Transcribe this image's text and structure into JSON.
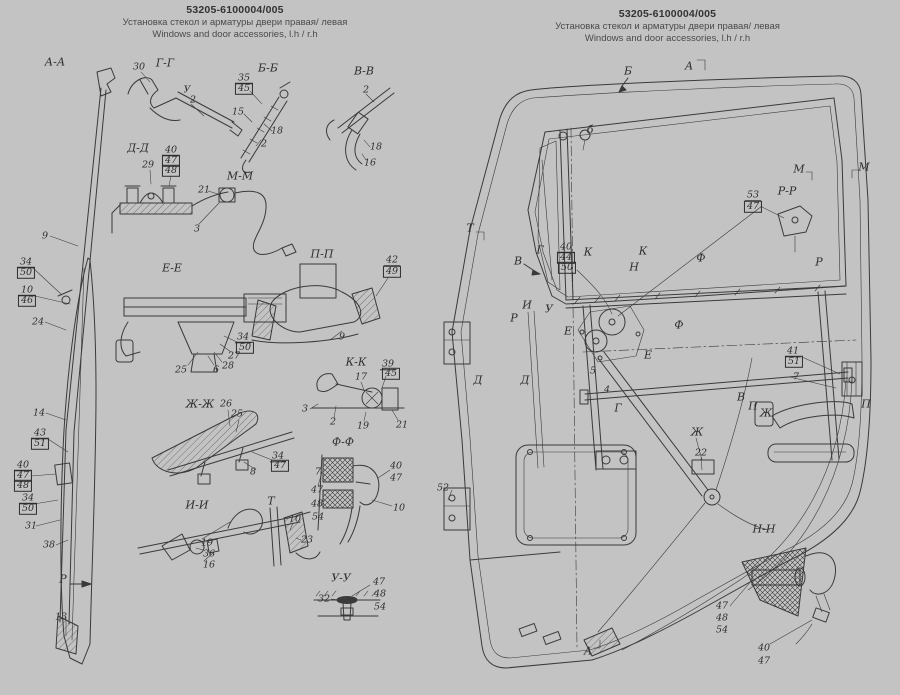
{
  "page": {
    "bg_color": "#c3c3c3",
    "ink_color": "#3a3a3a"
  },
  "titles": {
    "left": {
      "part_number": "53205-6100004/005",
      "title_ru": "Установка стекол и арматуры двери правая/ левая",
      "title_en": "Windows and door accessories, l.h / r.h"
    },
    "right": {
      "part_number": "53205-6100004/005",
      "title_ru": "Установка стекол и арматуры двери правая/ левая",
      "title_en": "Windows and door accessories, l.h / r.h"
    }
  },
  "labels": [
    {
      "t": "А-А",
      "x": 55,
      "y": 62,
      "s": "sec"
    },
    {
      "t": "Г-Г",
      "x": 165,
      "y": 63,
      "s": "sec"
    },
    {
      "t": "Б-Б",
      "x": 268,
      "y": 68,
      "s": "sec"
    },
    {
      "t": "В-В",
      "x": 364,
      "y": 71,
      "s": "sec"
    },
    {
      "t": "Д-Д",
      "x": 138,
      "y": 148,
      "s": "sec"
    },
    {
      "t": "М-М",
      "x": 240,
      "y": 176,
      "s": "sec"
    },
    {
      "t": "Е-Е",
      "x": 172,
      "y": 268,
      "s": "sec"
    },
    {
      "t": "П-П",
      "x": 322,
      "y": 254,
      "s": "sec"
    },
    {
      "t": "Ж-Ж",
      "x": 200,
      "y": 404,
      "s": "sec"
    },
    {
      "t": "К-К",
      "x": 356,
      "y": 362,
      "s": "sec"
    },
    {
      "t": "Ф-Ф",
      "x": 343,
      "y": 442,
      "s": "sec"
    },
    {
      "t": "И-И",
      "x": 197,
      "y": 505,
      "s": "sec"
    },
    {
      "t": "Т",
      "x": 271,
      "y": 501,
      "s": "sec"
    },
    {
      "t": "У-У",
      "x": 341,
      "y": 578,
      "s": "sec"
    },
    {
      "t": "Р",
      "x": 63,
      "y": 579,
      "s": "sec"
    },
    {
      "t": "30",
      "x": 139,
      "y": 67,
      "s": "p"
    },
    {
      "t": "У",
      "x": 187,
      "y": 90,
      "s": "p"
    },
    {
      "t": "2",
      "x": 193,
      "y": 100,
      "s": "p"
    },
    {
      "t": "35",
      "x": 244,
      "y": 79,
      "s": "ul"
    },
    {
      "t": "45",
      "x": 244,
      "y": 89,
      "s": "bx"
    },
    {
      "t": "15",
      "x": 238,
      "y": 112,
      "s": "p"
    },
    {
      "t": "18",
      "x": 277,
      "y": 131,
      "s": "p"
    },
    {
      "t": "2",
      "x": 264,
      "y": 144,
      "s": "p"
    },
    {
      "t": "2",
      "x": 366,
      "y": 90,
      "s": "p"
    },
    {
      "t": "18",
      "x": 376,
      "y": 147,
      "s": "p"
    },
    {
      "t": "16",
      "x": 370,
      "y": 163,
      "s": "p"
    },
    {
      "t": "29",
      "x": 148,
      "y": 165,
      "s": "p"
    },
    {
      "t": "40",
      "x": 171,
      "y": 151,
      "s": "ul"
    },
    {
      "t": "47",
      "x": 171,
      "y": 161,
      "s": "bx"
    },
    {
      "t": "48",
      "x": 171,
      "y": 171,
      "s": "bx"
    },
    {
      "t": "21",
      "x": 204,
      "y": 190,
      "s": "p"
    },
    {
      "t": "3",
      "x": 197,
      "y": 229,
      "s": "p"
    },
    {
      "t": "9",
      "x": 45,
      "y": 236,
      "s": "p"
    },
    {
      "t": "34",
      "x": 26,
      "y": 263,
      "s": "ul"
    },
    {
      "t": "50",
      "x": 26,
      "y": 273,
      "s": "bx"
    },
    {
      "t": "10",
      "x": 27,
      "y": 291,
      "s": "ul"
    },
    {
      "t": "46",
      "x": 27,
      "y": 301,
      "s": "bx"
    },
    {
      "t": "24",
      "x": 38,
      "y": 322,
      "s": "p"
    },
    {
      "t": "14",
      "x": 39,
      "y": 413,
      "s": "p"
    },
    {
      "t": "43",
      "x": 40,
      "y": 434,
      "s": "ul"
    },
    {
      "t": "51",
      "x": 40,
      "y": 444,
      "s": "bx"
    },
    {
      "t": "40",
      "x": 23,
      "y": 466,
      "s": "ul"
    },
    {
      "t": "47",
      "x": 23,
      "y": 476,
      "s": "bx"
    },
    {
      "t": "48",
      "x": 23,
      "y": 486,
      "s": "bx"
    },
    {
      "t": "34",
      "x": 28,
      "y": 499,
      "s": "ul"
    },
    {
      "t": "50",
      "x": 28,
      "y": 509,
      "s": "bx"
    },
    {
      "t": "31",
      "x": 31,
      "y": 526,
      "s": "p"
    },
    {
      "t": "38",
      "x": 49,
      "y": 545,
      "s": "p"
    },
    {
      "t": "13",
      "x": 61,
      "y": 617,
      "s": "p"
    },
    {
      "t": "34",
      "x": 243,
      "y": 338,
      "s": "ul"
    },
    {
      "t": "50",
      "x": 245,
      "y": 348,
      "s": "bx"
    },
    {
      "t": "27",
      "x": 234,
      "y": 356,
      "s": "p"
    },
    {
      "t": "28",
      "x": 228,
      "y": 366,
      "s": "p"
    },
    {
      "t": "6",
      "x": 216,
      "y": 370,
      "s": "p"
    },
    {
      "t": "25",
      "x": 181,
      "y": 370,
      "s": "p"
    },
    {
      "t": "42",
      "x": 392,
      "y": 261,
      "s": "ul"
    },
    {
      "t": "49",
      "x": 392,
      "y": 272,
      "s": "bx"
    },
    {
      "t": "9",
      "x": 342,
      "y": 337,
      "s": "p"
    },
    {
      "t": "26",
      "x": 226,
      "y": 404,
      "s": "p"
    },
    {
      "t": "25",
      "x": 237,
      "y": 414,
      "s": "p"
    },
    {
      "t": "34",
      "x": 278,
      "y": 457,
      "s": "ul"
    },
    {
      "t": "47",
      "x": 280,
      "y": 466,
      "s": "bx"
    },
    {
      "t": "8",
      "x": 253,
      "y": 472,
      "s": "p"
    },
    {
      "t": "17",
      "x": 361,
      "y": 377,
      "s": "p"
    },
    {
      "t": "39",
      "x": 388,
      "y": 365,
      "s": "ul"
    },
    {
      "t": "45",
      "x": 391,
      "y": 374,
      "s": "bx"
    },
    {
      "t": "3",
      "x": 305,
      "y": 409,
      "s": "p"
    },
    {
      "t": "2",
      "x": 333,
      "y": 422,
      "s": "p"
    },
    {
      "t": "19",
      "x": 363,
      "y": 426,
      "s": "p"
    },
    {
      "t": "21",
      "x": 402,
      "y": 425,
      "s": "p"
    },
    {
      "t": "7",
      "x": 318,
      "y": 472,
      "s": "p"
    },
    {
      "t": "47",
      "x": 317,
      "y": 490,
      "s": "p"
    },
    {
      "t": "48",
      "x": 317,
      "y": 504,
      "s": "p"
    },
    {
      "t": "54",
      "x": 318,
      "y": 517,
      "s": "p"
    },
    {
      "t": "40",
      "x": 396,
      "y": 466,
      "s": "p"
    },
    {
      "t": "47",
      "x": 396,
      "y": 478,
      "s": "p"
    },
    {
      "t": "10",
      "x": 399,
      "y": 508,
      "s": "p"
    },
    {
      "t": "19",
      "x": 207,
      "y": 543,
      "s": "p"
    },
    {
      "t": "36",
      "x": 209,
      "y": 554,
      "s": "p"
    },
    {
      "t": "16",
      "x": 209,
      "y": 565,
      "s": "p"
    },
    {
      "t": "10",
      "x": 295,
      "y": 519,
      "s": "p"
    },
    {
      "t": "23",
      "x": 307,
      "y": 540,
      "s": "p"
    },
    {
      "t": "32",
      "x": 324,
      "y": 599,
      "s": "p"
    },
    {
      "t": "47",
      "x": 379,
      "y": 582,
      "s": "p"
    },
    {
      "t": "48",
      "x": 380,
      "y": 594,
      "s": "p"
    },
    {
      "t": "54",
      "x": 380,
      "y": 607,
      "s": "p"
    },
    {
      "t": "Б",
      "x": 628,
      "y": 71,
      "s": "sec"
    },
    {
      "t": "А",
      "x": 689,
      "y": 66,
      "s": "sec"
    },
    {
      "t": "б",
      "x": 590,
      "y": 130,
      "s": "sec"
    },
    {
      "t": "Т",
      "x": 470,
      "y": 228,
      "s": "sec"
    },
    {
      "t": "М",
      "x": 799,
      "y": 169,
      "s": "sec"
    },
    {
      "t": "М",
      "x": 864,
      "y": 167,
      "s": "sec"
    },
    {
      "t": "Р-Р",
      "x": 787,
      "y": 191,
      "s": "sec"
    },
    {
      "t": "Г",
      "x": 540,
      "y": 250,
      "s": "sec"
    },
    {
      "t": "К",
      "x": 588,
      "y": 252,
      "s": "sec"
    },
    {
      "t": "К",
      "x": 643,
      "y": 251,
      "s": "sec"
    },
    {
      "t": "В",
      "x": 518,
      "y": 261,
      "s": "sec"
    },
    {
      "t": "Ф",
      "x": 701,
      "y": 258,
      "s": "sec"
    },
    {
      "t": "Р",
      "x": 819,
      "y": 262,
      "s": "sec"
    },
    {
      "t": "Н",
      "x": 634,
      "y": 267,
      "s": "sec"
    },
    {
      "t": "И",
      "x": 527,
      "y": 305,
      "s": "sec"
    },
    {
      "t": "У",
      "x": 549,
      "y": 309,
      "s": "sec"
    },
    {
      "t": "Р",
      "x": 514,
      "y": 318,
      "s": "sec"
    },
    {
      "t": "Е",
      "x": 568,
      "y": 331,
      "s": "sec"
    },
    {
      "t": "Ф",
      "x": 679,
      "y": 325,
      "s": "sec"
    },
    {
      "t": "Е",
      "x": 648,
      "y": 355,
      "s": "sec"
    },
    {
      "t": "Д",
      "x": 478,
      "y": 380,
      "s": "sec"
    },
    {
      "t": "Д",
      "x": 525,
      "y": 380,
      "s": "sec"
    },
    {
      "t": "Г",
      "x": 618,
      "y": 408,
      "s": "sec"
    },
    {
      "t": "В",
      "x": 741,
      "y": 397,
      "s": "sec"
    },
    {
      "t": "П",
      "x": 753,
      "y": 406,
      "s": "sec"
    },
    {
      "t": "Ж",
      "x": 766,
      "y": 413,
      "s": "sec"
    },
    {
      "t": "Ж",
      "x": 697,
      "y": 432,
      "s": "sec"
    },
    {
      "t": "П",
      "x": 866,
      "y": 404,
      "s": "sec"
    },
    {
      "t": "Н-Н",
      "x": 764,
      "y": 529,
      "s": "sec"
    },
    {
      "t": "А",
      "x": 588,
      "y": 651,
      "s": "sec"
    },
    {
      "t": "53",
      "x": 753,
      "y": 196,
      "s": "ul"
    },
    {
      "t": "47",
      "x": 753,
      "y": 207,
      "s": "bx"
    },
    {
      "t": "40",
      "x": 566,
      "y": 248,
      "s": "ul"
    },
    {
      "t": "44",
      "x": 566,
      "y": 258,
      "s": "bx"
    },
    {
      "t": "50",
      "x": 567,
      "y": 268,
      "s": "bx"
    },
    {
      "t": "41",
      "x": 793,
      "y": 352,
      "s": "ul"
    },
    {
      "t": "51",
      "x": 794,
      "y": 362,
      "s": "bx"
    },
    {
      "t": "7",
      "x": 796,
      "y": 377,
      "s": "p"
    },
    {
      "t": "5",
      "x": 593,
      "y": 371,
      "s": "p"
    },
    {
      "t": "4",
      "x": 607,
      "y": 390,
      "s": "p"
    },
    {
      "t": "22",
      "x": 701,
      "y": 453,
      "s": "p"
    },
    {
      "t": "52",
      "x": 443,
      "y": 488,
      "s": "p"
    },
    {
      "t": "47",
      "x": 722,
      "y": 606,
      "s": "p"
    },
    {
      "t": "48",
      "x": 722,
      "y": 618,
      "s": "p"
    },
    {
      "t": "54",
      "x": 722,
      "y": 630,
      "s": "p"
    },
    {
      "t": "40",
      "x": 764,
      "y": 648,
      "s": "p"
    },
    {
      "t": "47",
      "x": 764,
      "y": 661,
      "s": "p"
    }
  ]
}
